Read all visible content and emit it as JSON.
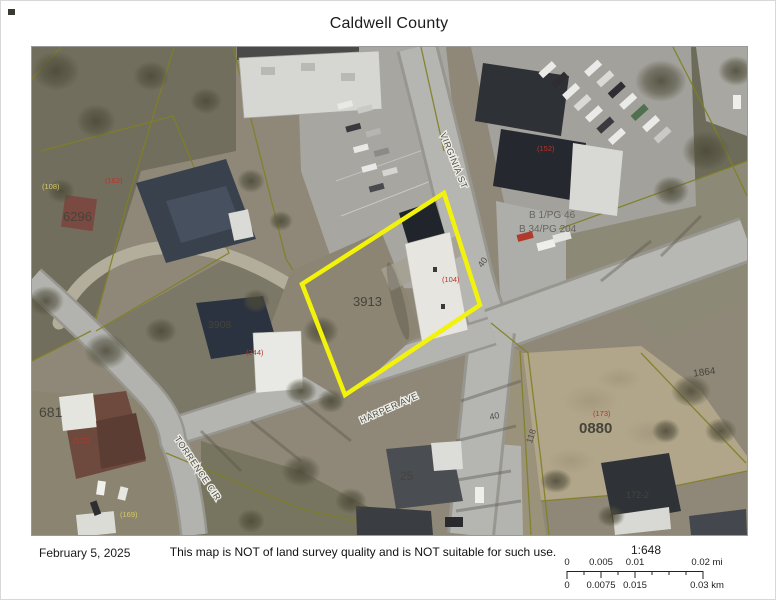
{
  "title": "Caldwell County",
  "footer": {
    "date": "February 5, 2025",
    "disclaimer": "This map is NOT of land survey quality and is NOT suitable for such use."
  },
  "scalebar": {
    "ratio": "1:648",
    "mi_ticks": [
      "0",
      "0.005",
      "0.01",
      "0.02 mi"
    ],
    "km_ticks": [
      "0",
      "0.0075",
      "0.015",
      "0.03 km"
    ]
  },
  "map": {
    "highlighted_parcel": "3913",
    "highlight_color": "#f2f20a",
    "street_labels": [
      "VIRGINIA ST",
      "HARPER AVE",
      "TORRENCE CIR"
    ],
    "parcel_numbers": [
      "3913",
      "6296",
      "3908",
      "681",
      "0880",
      "25",
      "172-2",
      "1864"
    ],
    "dimension_labels": [
      "40",
      "40",
      "118"
    ],
    "address_labels": [
      "(104)",
      "(108)",
      "(162)",
      "(152)",
      "(244)",
      "(172)",
      "(169)",
      "(173)"
    ],
    "plat_labels": [
      "B 1/PG 46",
      "B 34/PG 204"
    ]
  }
}
